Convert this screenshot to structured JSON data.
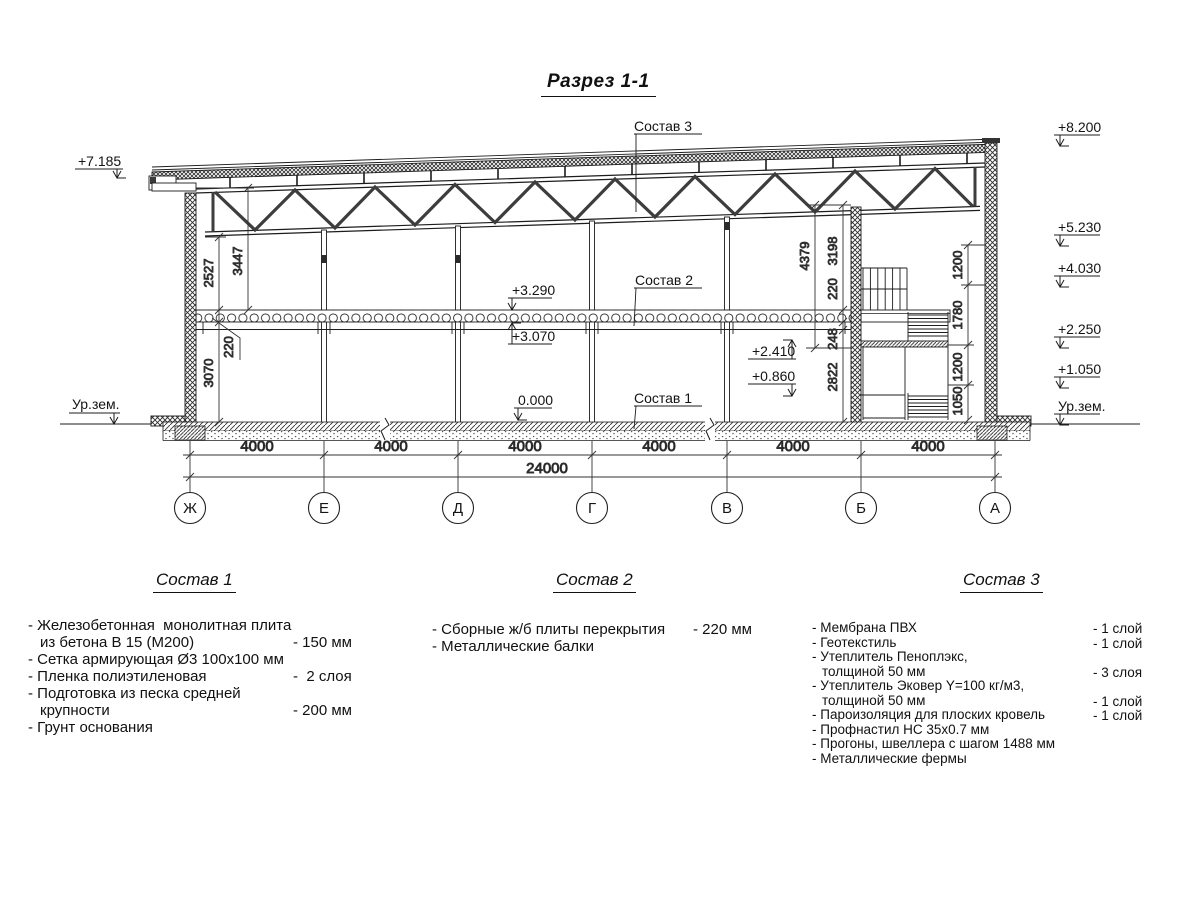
{
  "title": "Разрез 1-1",
  "drawing": {
    "callouts": {
      "s1": "Состав 1",
      "s2": "Состав 2",
      "s3": "Состав 3"
    },
    "elevations": {
      "left_top": "+7.185",
      "ground_left": "Ур.зем.",
      "right": [
        "+8.200",
        "+5.230",
        "+4.030",
        "+2.250",
        "+1.050"
      ],
      "ground_right": "Ур.зем.",
      "slab_top": "+3.290",
      "slab_bottom": "+3.070",
      "zero": "0.000",
      "stair_upper": "+2.410",
      "stair_lower": "+0.860"
    },
    "dims_left": [
      "2527",
      "3447",
      "220",
      "3070"
    ],
    "dims_axis_b": [
      "4379",
      "3198",
      "220",
      "248",
      "2822"
    ],
    "dims_axis_a": [
      "1200",
      "1780",
      "1200",
      "1050"
    ],
    "dims_bottom": {
      "segments": [
        "4000",
        "4000",
        "4000",
        "4000",
        "4000",
        "4000"
      ],
      "total": "24000"
    },
    "axes": [
      "Ж",
      "Е",
      "Д",
      "Г",
      "В",
      "Б",
      "А"
    ]
  },
  "legend": {
    "s1": {
      "heading": "Состав 1",
      "items": [
        {
          "lines": [
            "- Железобетонная  монолитная плита",
            "из бетона В 15 (М200)"
          ],
          "value": "- 150 мм"
        },
        {
          "lines": [
            "- Сетка армирующая Ø3 100х100 мм"
          ]
        },
        {
          "lines": [
            "- Пленка полиэтиленовая"
          ],
          "value": "-  2 слоя"
        },
        {
          "lines": [
            "- Подготовка из песка средней",
            "крупности"
          ],
          "value": "- 200 мм"
        },
        {
          "lines": [
            "- Грунт основания"
          ]
        }
      ]
    },
    "s2": {
      "heading": "Состав 2",
      "items": [
        {
          "lines": [
            "- Сборные ж/б плиты перекрытия"
          ],
          "value": "- 220 мм"
        },
        {
          "lines": [
            "- Металлические балки"
          ]
        }
      ]
    },
    "s3": {
      "heading": "Состав 3",
      "items": [
        {
          "lines": [
            "- Мембрана ПВХ"
          ],
          "value": "- 1 слой"
        },
        {
          "lines": [
            "- Геотекстиль"
          ],
          "value": "- 1 слой"
        },
        {
          "lines": [
            "- Утеплитель Пеноплэкс,",
            "толщиной 50 мм"
          ],
          "value": "- 3 слоя"
        },
        {
          "lines": [
            "- Утеплитель Эковер Y=100 кг/м3,",
            "толщиной 50 мм"
          ],
          "value": "- 1 слой"
        },
        {
          "lines": [
            "- Пароизоляция для плоских кровель"
          ],
          "value": "- 1 слой"
        },
        {
          "lines": [
            "- Профнастил НС 35х0.7 мм"
          ]
        },
        {
          "lines": [
            "- Прогоны, швеллера с шагом 1488 мм"
          ]
        },
        {
          "lines": [
            "- Металлические фермы"
          ]
        }
      ]
    }
  }
}
